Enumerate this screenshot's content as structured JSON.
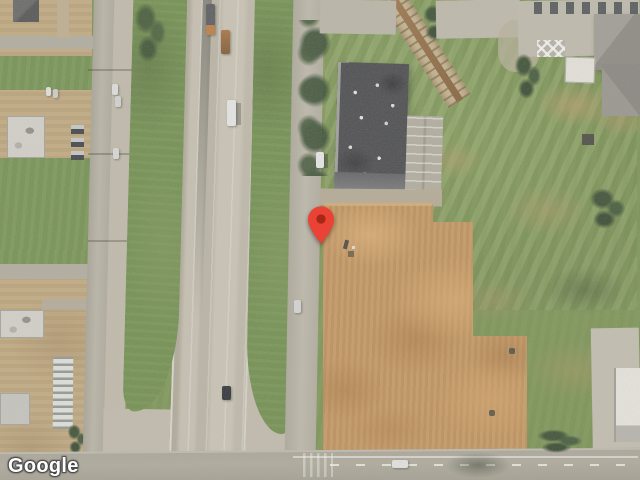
{
  "map": {
    "imagery": "satellite",
    "attribution_text": "Google",
    "marker": {
      "color": "#EA4335",
      "dot_color": "#A52714",
      "tip_x": 321,
      "tip_y": 244
    }
  }
}
